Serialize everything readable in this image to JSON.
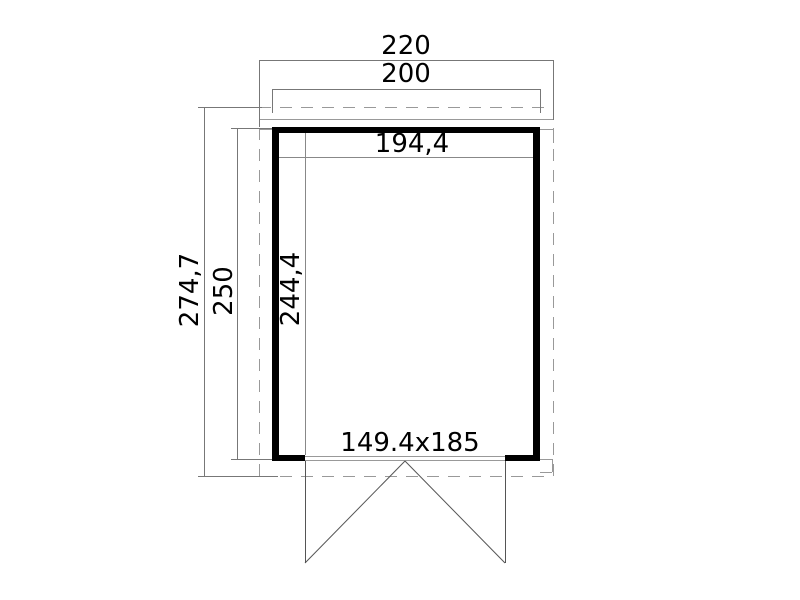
{
  "plan": {
    "labels": {
      "overall_width": "220",
      "wall_outer_width": "200",
      "interior_width": "194,4",
      "overall_depth": "274,7",
      "wall_outer_depth": "250",
      "interior_depth": "244,4",
      "door_size": "149.4x185"
    }
  },
  "colors": {
    "wall": "#000000",
    "dimension_line": "#777777",
    "interior_dimension_line": "#888888",
    "roof_outline": "#999999",
    "door_line": "#555555",
    "text": "#000000",
    "background": "#ffffff"
  }
}
